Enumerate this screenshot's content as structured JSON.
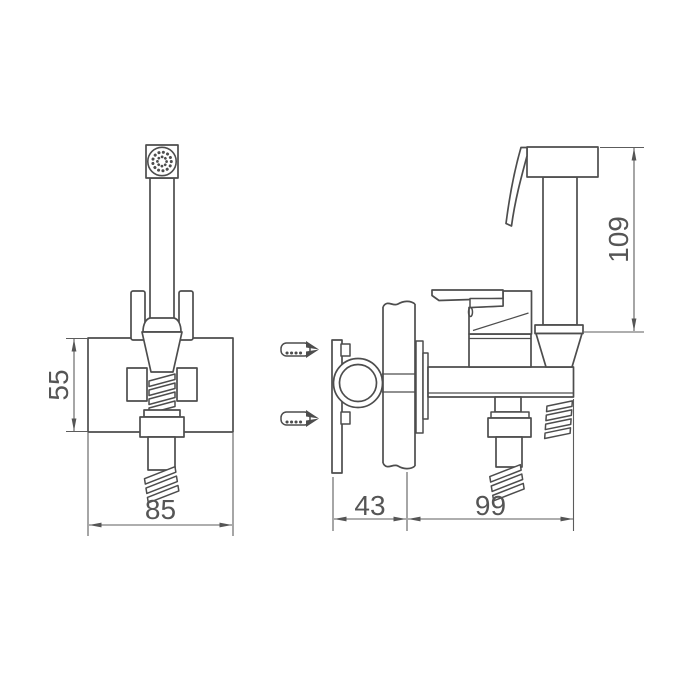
{
  "diagram": {
    "type": "technical-installation-drawing",
    "views": {
      "front_view": "handheld-bidet-sprayer-with-wall-holder",
      "side_view": "wall-mounted-valve-body-with-sprayer"
    },
    "dimensions": {
      "holder_plate_height": "55",
      "holder_plate_width": "85",
      "wall_inset_depth": "43",
      "valve_body_projection": "99",
      "sprayer_height": "109"
    },
    "colors": {
      "background": "#ffffff",
      "part_line": "#4d4d4d",
      "dimension_line": "#5c5c5c",
      "dimension_text": "#555555"
    }
  }
}
